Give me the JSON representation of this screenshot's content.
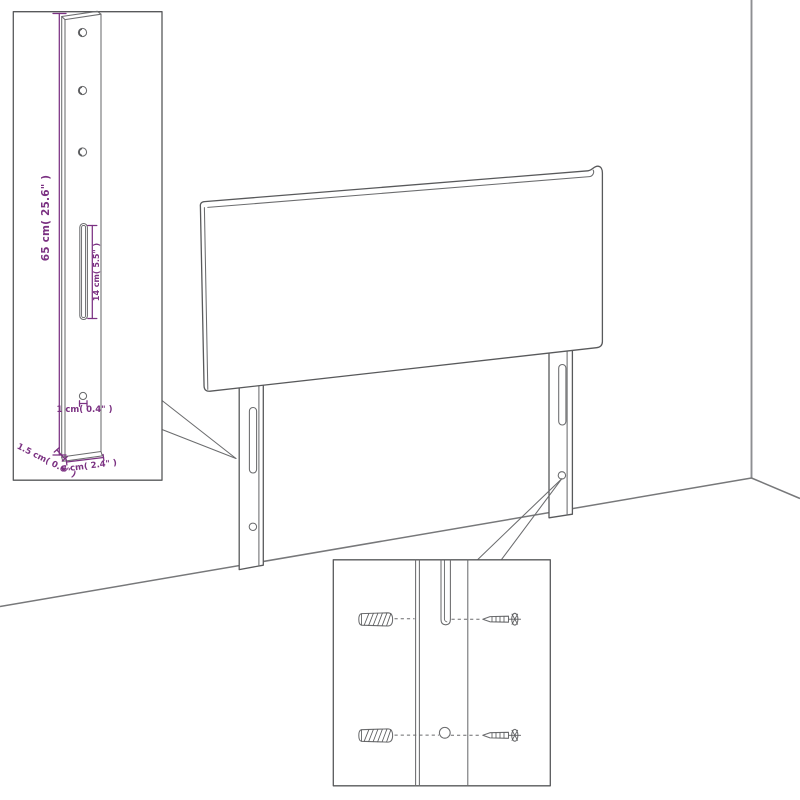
{
  "diagram_kind": "headboard-assembly-dimension-diagram",
  "colors": {
    "background": "#ffffff",
    "line_gray": "#58595b",
    "wall_gray": "#8d8f92",
    "floor_gray": "#77787a",
    "dimension_purple": "#7b3182"
  },
  "leg_detail_inset": {
    "height_label": "65 cm( 25.6\" )",
    "slot_label": "14 cm( 5.5\" )",
    "hole_label": "1 cm( 0.4\" )",
    "thickness_label": "1.5 cm( 0.6\" )",
    "width_label": "6 cm( 2.4\" )"
  },
  "mounting_detail_inset": {
    "parts": {
      "wall_plug": "wall-plug",
      "screw": "screw",
      "slot": "keyhole-slot",
      "hole": "screw-hole"
    }
  }
}
